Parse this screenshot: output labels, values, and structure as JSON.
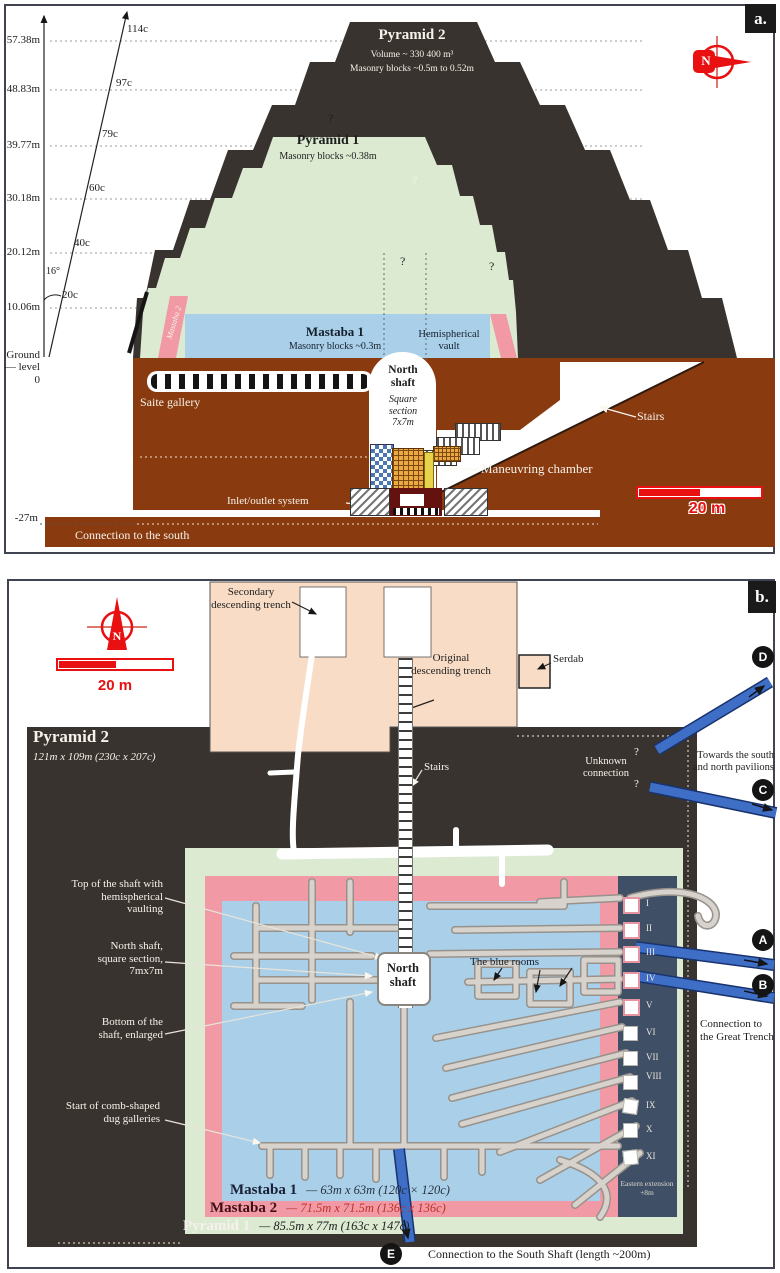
{
  "colors": {
    "accent_red": "#e81010",
    "arrow_blue": "#3e6ec5",
    "ground_brown": "#8a3a0f",
    "pyramid2_dark": "#38332e",
    "pyramid1_green": "#dcead2",
    "mastaba1_blue": "#a9cfe9",
    "mastaba2_pink": "#f19aa5",
    "trench_peach": "#f8dcc5",
    "eastern_navy": "#3e4f66"
  },
  "panel_a": {
    "tag": "a.",
    "compass_n": "N",
    "scale_label": "20 m",
    "axis": {
      "elevations": [
        {
          "m": "57.38m",
          "c": "114c"
        },
        {
          "m": "48.83m",
          "c": "97c"
        },
        {
          "m": "39.77m",
          "c": "79c"
        },
        {
          "m": "30.18m",
          "c": "60c"
        },
        {
          "m": "20.12m",
          "c": "40c"
        },
        {
          "m": "10.06m",
          "c": "20c"
        }
      ],
      "angle": "16°",
      "ground_1": "Ground",
      "ground_2": "— level",
      "ground_3": "0",
      "depth": "-27m"
    },
    "pyramid2_title": "Pyramid 2",
    "pyramid2_volume": "Volume ~ 330 400 m³",
    "pyramid2_blocks": "Masonry blocks ~0.5m to 0.52m",
    "pyramid1_title": "Pyramid 1",
    "pyramid1_blocks": "Masonry blocks ~0.38m",
    "mastaba1_title": "Mastaba 1",
    "mastaba1_blocks": "Masonry blocks ~0.3m",
    "mastaba2_label": "Mastaba 2",
    "vault_label": "Hemispherical vault",
    "north_shaft_title": "North shaft",
    "north_shaft_sub": "Square section 7x7m",
    "saite_label": "Saite gallery",
    "stairs_label": "Stairs",
    "maneuvring_label": "Maneuvring chamber",
    "inlet_label": "Inlet/outlet system",
    "south_label": "Connection to the south",
    "q": "?"
  },
  "panel_b": {
    "tag": "b.",
    "compass_n": "N",
    "scale_label": "20 m",
    "pyramid2_title": "Pyramid 2",
    "pyramid2_dims": "121m x 109m (230c x 207c)",
    "secondary_trench": "Secondary descending trench",
    "original_trench": "Original descending trench",
    "serdab": "Serdab",
    "stairs": "Stairs",
    "unknown": "Unknown connection",
    "towards": "Towards the south and north pavilions",
    "great_trench": "Connection to the Great Trench",
    "label_top_shaft": "Top of the shaft with hemispherical vaulting",
    "label_north_shaft": "North shaft, square section, 7mx7m",
    "label_bottom_shaft": "Bottom of the shaft, enlarged",
    "label_comb": "Start of comb-shaped dug galleries",
    "north_shaft_box": "North shaft",
    "blue_rooms": "The blue rooms",
    "eastern_extension": "Eastern extension +8m",
    "legend": [
      {
        "name": "Mastaba 1",
        "dims": "— 63m x 63m (120c × 120c)"
      },
      {
        "name": "Mastaba 2",
        "dims": "— 71.5m x 71.5m (136c x 136c)"
      },
      {
        "name": "Pyramid 1",
        "dims": "— 85.5m x 77m (163c x 147c)"
      }
    ],
    "south_shaft": "Connection to the South Shaft (length ~200m)",
    "gallery_numerals": [
      "I",
      "II",
      "III",
      "IV",
      "V",
      "VI",
      "VII",
      "VIII",
      "IX",
      "X",
      "XI"
    ],
    "markers": [
      "A",
      "B",
      "C",
      "D",
      "E"
    ],
    "q": "?"
  }
}
